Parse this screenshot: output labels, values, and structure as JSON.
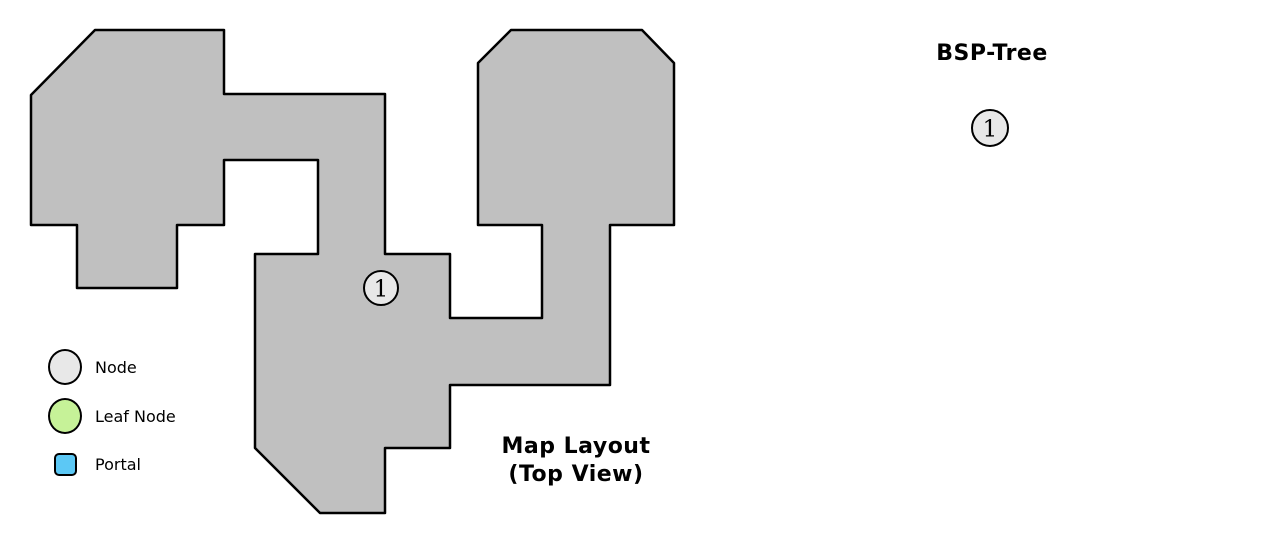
{
  "colors": {
    "map_fill": "#c0c0c0",
    "map_stroke": "#000000",
    "node_fill": "#e8e8e8",
    "leaf_fill": "#c6f298",
    "portal_fill": "#5cc8f5",
    "text": "#000000"
  },
  "map": {
    "label_line1": "Map Layout",
    "label_line2": "(Top View)",
    "polygon": [
      [
        95,
        30
      ],
      [
        224,
        30
      ],
      [
        224,
        94
      ],
      [
        385,
        94
      ],
      [
        385,
        254
      ],
      [
        450,
        254
      ],
      [
        450,
        318
      ],
      [
        542,
        318
      ],
      [
        542,
        225
      ],
      [
        478,
        225
      ],
      [
        478,
        63
      ],
      [
        511,
        30
      ],
      [
        642,
        30
      ],
      [
        674,
        63
      ],
      [
        674,
        225
      ],
      [
        610,
        225
      ],
      [
        610,
        385
      ],
      [
        450,
        385
      ],
      [
        450,
        448
      ],
      [
        385,
        448
      ],
      [
        385,
        513
      ],
      [
        320,
        513
      ],
      [
        255,
        448
      ],
      [
        255,
        254
      ],
      [
        318,
        254
      ],
      [
        318,
        160
      ],
      [
        224,
        160
      ],
      [
        224,
        225
      ],
      [
        177,
        225
      ],
      [
        177,
        288
      ],
      [
        77,
        288
      ],
      [
        77,
        225
      ],
      [
        31,
        225
      ],
      [
        31,
        95
      ]
    ],
    "marker": {
      "label": "1",
      "x": 381,
      "y": 288,
      "r": 17
    }
  },
  "tree": {
    "title": "BSP-Tree",
    "nodes": [
      {
        "label": "1",
        "x": 990,
        "y": 128,
        "r": 18,
        "type": "node"
      }
    ]
  },
  "legend": {
    "items": [
      {
        "label": "Node",
        "shape": "circle",
        "color": "#e8e8e8"
      },
      {
        "label": "Leaf Node",
        "shape": "circle",
        "color": "#c6f298"
      },
      {
        "label": "Portal",
        "shape": "square",
        "color": "#5cc8f5"
      }
    ]
  }
}
